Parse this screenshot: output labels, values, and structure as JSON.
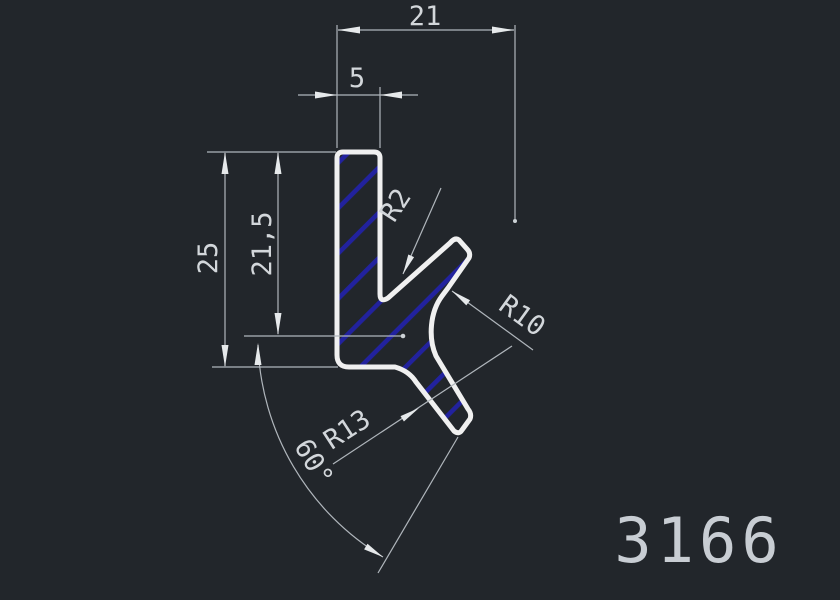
{
  "drawing": {
    "type": "cad-profile-drawing",
    "part_number": "3166",
    "colors": {
      "background": "#22262b",
      "profile_outline": "#f0f0f0",
      "hatch_blue": "#22229e",
      "dimension_lines": "#b0b6bc",
      "dimension_text": "#d3d7db",
      "part_number_text": "#c8cdd3"
    },
    "dimensions": {
      "top_width": {
        "label": "21"
      },
      "wall_width": {
        "label": "5"
      },
      "overall_height": {
        "label": "25"
      },
      "inner_height": {
        "label": "21,5"
      },
      "inner_fillet_radius": {
        "label": "R2"
      },
      "right_fillet_radius": {
        "label": "R10"
      },
      "bottom_fillet_radius": {
        "label": "R13"
      },
      "leg_angle": {
        "label": "60°"
      }
    }
  }
}
